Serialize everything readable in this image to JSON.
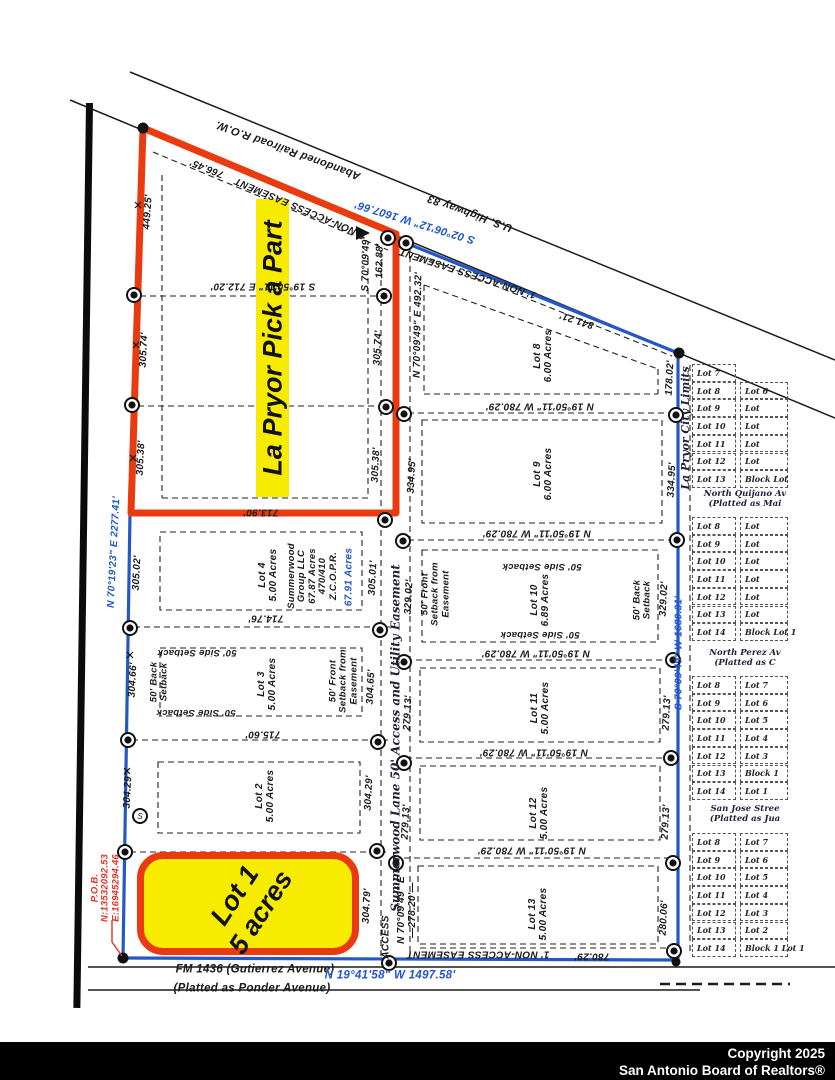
{
  "map": {
    "banner": "La Pryor Pick a Part",
    "lot1": {
      "line1": "Lot 1",
      "line2": "5 acres"
    },
    "footer": {
      "line1": "Copyright 2025",
      "line2": "San Antonio Board of Realtors®"
    },
    "colors": {
      "boundary_red": "#ea3b10",
      "boundary_blue": "#2458c4",
      "highlight_yellow": "#f7ec00",
      "label_blue": "#1f55cc",
      "pob_red": "#e03325"
    },
    "labels": [
      {
        "name": "road-us-highway-83",
        "text": "U.S. Highway 83"
      },
      {
        "name": "road-abandoned-railroad",
        "text": "Abandoned Railroad R.O.W."
      },
      {
        "name": "bearing-highway",
        "text": "S 02°06'12\" W 1607.66'"
      },
      {
        "name": "dim-766-45",
        "text": "766.45'"
      },
      {
        "name": "easement-top",
        "text": "1' NON-ACCESS EASEMENT"
      },
      {
        "name": "easement-diagonal",
        "text": "1' NON-ACCESS EASEMENT"
      },
      {
        "name": "dim-841-21",
        "text": "841.21'"
      },
      {
        "name": "bearing-n70-492",
        "text": "N 70°09'49\" E 492.32'"
      },
      {
        "name": "bearing-s70-162",
        "text": "S 70°09'49\""
      },
      {
        "name": "dim-162-88",
        "text": "162.88'"
      },
      {
        "name": "bearing-s19-712",
        "text": "S 19°50'11\" E 712.20'"
      },
      {
        "name": "dim-449-25",
        "text": "449.25'"
      },
      {
        "name": "dim-305-74-w",
        "text": "305.74'"
      },
      {
        "name": "dim-305-38-w",
        "text": "305.38'"
      },
      {
        "name": "bearing-n70-2277",
        "text": "N 70°19'23\" E 2277.41'"
      },
      {
        "name": "dim-305-02-w",
        "text": "305.02'"
      },
      {
        "name": "dim-304-66-w",
        "text": "304.66'"
      },
      {
        "name": "dim-304-29-w",
        "text": "304.29'"
      },
      {
        "name": "dim-305-74-e",
        "text": "305.74'"
      },
      {
        "name": "dim-305-38-e",
        "text": "305.38'"
      },
      {
        "name": "dim-305-01",
        "text": "305.01'"
      },
      {
        "name": "dim-304-65",
        "text": "304.65'"
      },
      {
        "name": "dim-304-29-e",
        "text": "304.29'"
      },
      {
        "name": "dim-304-79",
        "text": "304.79'"
      },
      {
        "name": "dim-713-90",
        "text": "713.90'"
      },
      {
        "name": "dim-714-76",
        "text": "714.76'"
      },
      {
        "name": "dim-715-60",
        "text": "715.60'"
      },
      {
        "name": "summerwood-lane-easement",
        "text": "Summerwood Lane 50' Access and Utility Easement"
      },
      {
        "name": "lot-4-label",
        "lines": [
          "Lot 4",
          "5.00 Acres"
        ]
      },
      {
        "name": "summerwood-group",
        "lines": [
          "Summerwood",
          "Group LLC",
          "67.87 Acres",
          "470/410",
          "Z.C.O.P.R."
        ]
      },
      {
        "name": "acres-67-91",
        "text": "67.91 Acres"
      },
      {
        "name": "lot-3-label",
        "lines": [
          "Lot 3",
          "5.00 Acres"
        ]
      },
      {
        "name": "setback-back-lot3",
        "lines": [
          "50' Back",
          "Setback"
        ]
      },
      {
        "name": "setback-side-lot3-top",
        "text": "50' Side Setback"
      },
      {
        "name": "setback-side-lot3-bottom",
        "text": "50' Side Setback"
      },
      {
        "name": "setback-front-lot3",
        "lines": [
          "50' Front",
          "Setback from",
          "Easement"
        ]
      },
      {
        "name": "lot-2-label",
        "lines": [
          "Lot 2",
          "5.00 Acres"
        ]
      },
      {
        "name": "dim-329-02-w",
        "text": "329.02'"
      },
      {
        "name": "access-label",
        "text": "ACCESS"
      },
      {
        "name": "bearing-n70-278",
        "lines": [
          "N 70°09'49\" E",
          "—278.20'—"
        ]
      },
      {
        "name": "lot-8-label",
        "lines": [
          "Lot 8",
          "6.00 Acres"
        ]
      },
      {
        "name": "dim-178-02",
        "text": "178.02'"
      },
      {
        "name": "bearing-n19-780-1",
        "text": "N 19°50'11\" W 780.29'"
      },
      {
        "name": "bearing-n19-780-2",
        "text": "N 19°50'11\" W 780.29'"
      },
      {
        "name": "bearing-n19-780-3",
        "text": "N 19°50'11\" W 780.29'"
      },
      {
        "name": "bearing-n19-780-4",
        "text": "N 19°50'11\" W 780.29'"
      },
      {
        "name": "bearing-n19-780-5",
        "text": "N 19°50'11\" W 780.29'"
      },
      {
        "name": "lot-9-label",
        "lines": [
          "Lot 9",
          "6.00 Acres"
        ]
      },
      {
        "name": "dim-334-95-w",
        "text": "334.95'"
      },
      {
        "name": "dim-334-95-e",
        "text": "334.95'"
      },
      {
        "name": "lot-10-label",
        "lines": [
          "Lot 10",
          "6.89 Acres"
        ]
      },
      {
        "name": "setback-side-lot10-top",
        "text": "50' Side Setback"
      },
      {
        "name": "setback-side-lot10-bottom",
        "text": "50' Side Setback"
      },
      {
        "name": "setback-back-lot10",
        "lines": [
          "50' Back",
          "Setback"
        ]
      },
      {
        "name": "setback-front-lot10",
        "lines": [
          "50' Front",
          "Setback from",
          "Easement"
        ]
      },
      {
        "name": "dim-329-02-e",
        "text": "329.02'"
      },
      {
        "name": "lot-11-label",
        "lines": [
          "Lot 11",
          "5.00 Acres"
        ]
      },
      {
        "name": "dim-279-13-w1",
        "text": "279.13'"
      },
      {
        "name": "dim-279-13-e1",
        "text": "279.13'"
      },
      {
        "name": "lot-12-label",
        "lines": [
          "Lot 12",
          "5.00 Acres"
        ]
      },
      {
        "name": "dim-279-13-w2",
        "text": "279.13'"
      },
      {
        "name": "dim-279-13-e2",
        "text": "279.13'"
      },
      {
        "name": "lot-13-label",
        "lines": [
          "Lot 13",
          "5.00 Acres"
        ]
      },
      {
        "name": "dim-280-06",
        "text": "280.06'"
      },
      {
        "name": "easement-bottom",
        "text": "1' NON-ACCESS EASEMENT"
      },
      {
        "name": "dim-780-29-b",
        "text": "780.29'"
      },
      {
        "name": "city-limits",
        "text": "La Pryor City Limits"
      },
      {
        "name": "bearing-s70-1680",
        "text": "S 70°09'49\" W 1680.31'"
      },
      {
        "name": "pob",
        "lines": [
          "P.O.B.",
          "N:13532092.53",
          "E:16945294.46"
        ]
      },
      {
        "name": "road-fm-1436",
        "text": "FM 1436 (Gutierrez Avenue)"
      },
      {
        "name": "road-fm-platted",
        "text": "(Platted as Ponder Avenue)"
      },
      {
        "name": "bearing-n19-1497",
        "text": "N 19°41'58\" W 1497.58'"
      }
    ],
    "right_strip": {
      "groups": [
        {
          "name": "city-block-a",
          "col1": [
            "Lot 7",
            "Lot 8",
            "Lot 9",
            "Lot 10",
            "Lot 11",
            "Lot 12",
            "Lot 13"
          ],
          "col2": [
            "",
            "Lot 6",
            "Lot",
            "Lot",
            "Lot",
            "Lot",
            "Block Lot"
          ]
        },
        {
          "name": "city-block-b",
          "col1": [
            "Lot 8",
            "Lot 9",
            "Lot 10",
            "Lot 11",
            "Lot 12",
            "Lot 13",
            "Lot 14"
          ],
          "col2": [
            "Lot",
            "Lot",
            "Lot",
            "Lot",
            "Lot",
            "Lot",
            "Block Lot 1"
          ]
        },
        {
          "name": "city-block-c",
          "col1": [
            "Lot 8",
            "Lot 9",
            "Lot 10",
            "Lot 11",
            "Lot 12",
            "Lot 13",
            "Lot 14"
          ],
          "col2": [
            "Lot 7",
            "Lot 6",
            "Lot 5",
            "Lot 4",
            "Lot 3",
            "Block 1",
            "Lot 1"
          ]
        },
        {
          "name": "city-block-d",
          "col1": [
            "Lot 8",
            "Lot 9",
            "Lot 10",
            "Lot 11",
            "Lot 12",
            "Lot 13",
            "Lot 14"
          ],
          "col2": [
            "Lot 7",
            "Lot 6",
            "Lot 5",
            "Lot 4",
            "Lot 3",
            "Lot 2",
            "Block 1 Lot 1"
          ]
        }
      ],
      "streets": [
        {
          "name": "street-quijano",
          "lines": [
            "North Quijano Av",
            "(Platted as Mai"
          ]
        },
        {
          "name": "street-perez",
          "lines": [
            "North Perez Av",
            "(Platted as C"
          ]
        },
        {
          "name": "street-san-jose",
          "lines": [
            "San Jose Stree",
            "(Platted as Jua"
          ]
        }
      ]
    }
  }
}
